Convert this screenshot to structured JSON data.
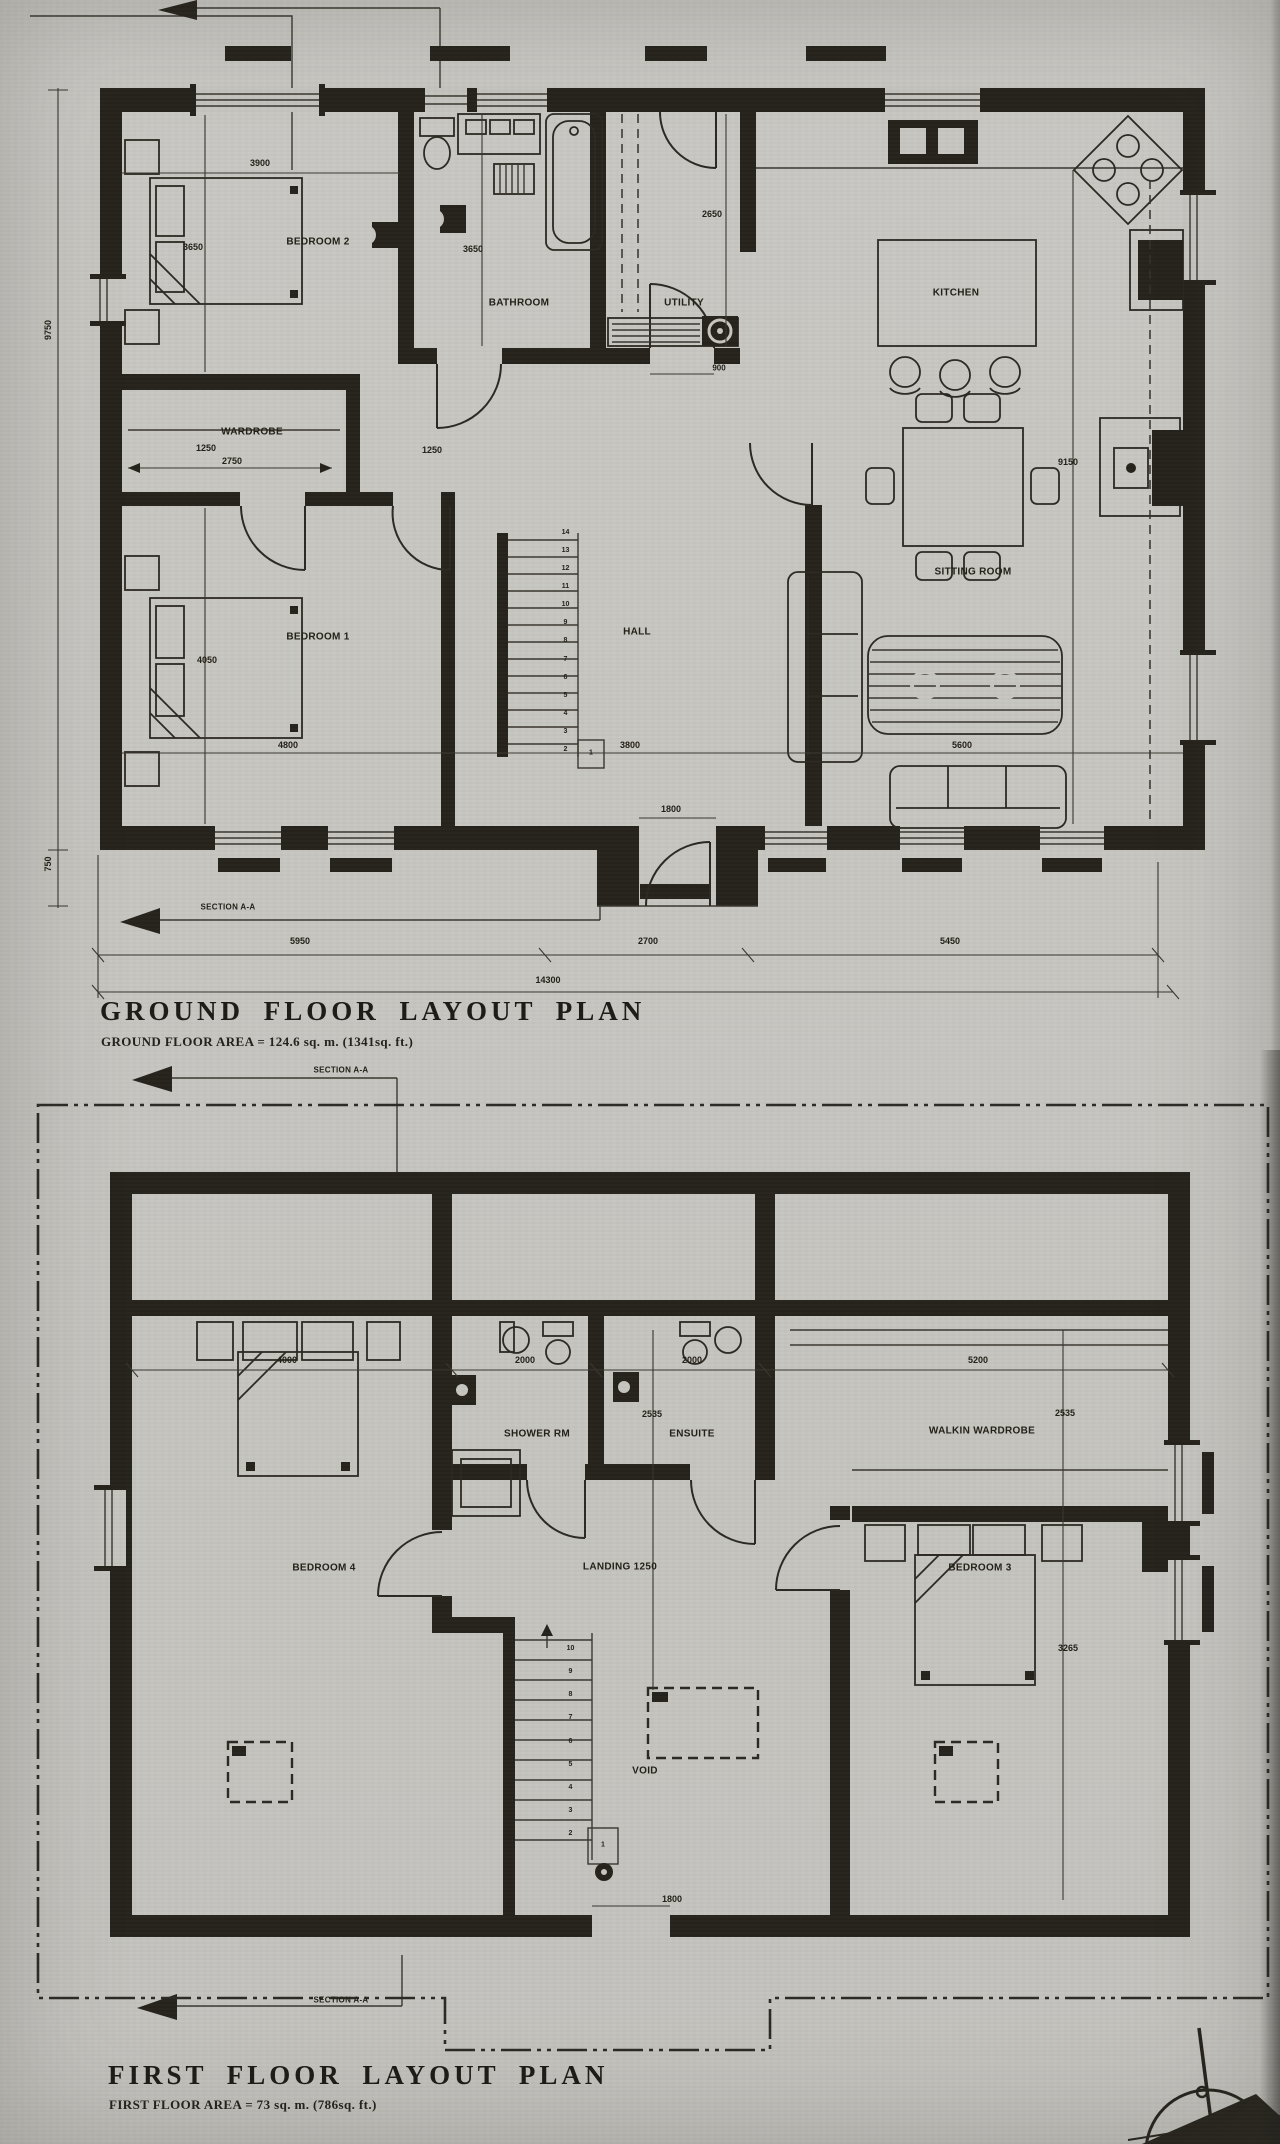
{
  "section": {
    "label": "SECTION A-A"
  },
  "ground_floor": {
    "title": "GROUND FLOOR LAYOUT PLAN",
    "area_note": "GROUND FLOOR AREA = 124.6 sq. m. (1341sq. ft.)",
    "rooms": {
      "bedroom2": "BEDROOM 2",
      "bathroom": "BATHROOM",
      "utility": "UTILITY",
      "kitchen": "KITCHEN",
      "wardrobe": "WARDROBE",
      "bedroom1": "BEDROOM 1",
      "hall": "HALL",
      "sitting_room": "SITTING ROOM"
    },
    "dims": {
      "bedroom2_width": "3900",
      "bedroom2_depth": "3650",
      "bathroom_side": "3650",
      "utility_side": "2650",
      "utility_door": "900",
      "wardrobe_depth": "1250",
      "wardrobe_width": "2750",
      "hall_passage": "1250",
      "bedroom1_depth": "4050",
      "bedroom1_width": "4800",
      "hall_width": "3800",
      "sitting_width": "5600",
      "sitting_depth": "9150",
      "entrance_door": "1800",
      "side_overall": "9750",
      "porch_depth": "750",
      "front_left": "5950",
      "front_porch": "2700",
      "front_right": "5450",
      "front_overall": "14300"
    },
    "stairs": [
      "1",
      "2",
      "3",
      "4",
      "5",
      "6",
      "7",
      "8",
      "9",
      "10",
      "11",
      "12",
      "13",
      "14"
    ]
  },
  "first_floor": {
    "title": "FIRST FLOOR LAYOUT PLAN",
    "area_note": "FIRST FLOOR AREA = 73 sq. m. (786sq. ft.)",
    "rooms": {
      "bedroom4": "BEDROOM 4",
      "shower_rm": "SHOWER RM",
      "ensuite": "ENSUITE",
      "landing": "LANDING 1250",
      "walkin_wardrobe": "WALKIN WARDROBE",
      "bedroom3": "BEDROOM 3",
      "void": "VOID"
    },
    "dims": {
      "bedroom4_bed": "4000",
      "shower_width": "2000",
      "ensuite_width": "2000",
      "ensuite_depth": "2535",
      "wardrobe_width": "5200",
      "wardrobe_depth": "2535",
      "bedroom3_depth": "3265",
      "stair_door": "1800"
    },
    "stairs": [
      "1",
      "2",
      "3",
      "4",
      "5",
      "6",
      "7",
      "8",
      "9",
      "10"
    ]
  }
}
